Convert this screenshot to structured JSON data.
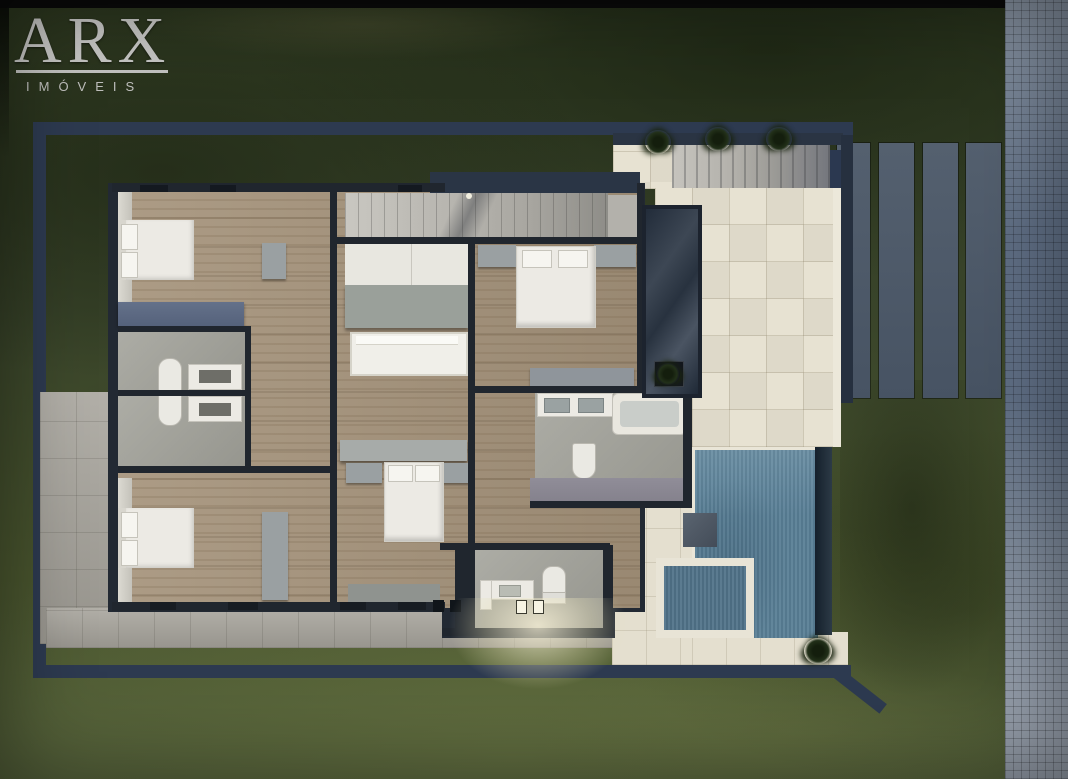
{
  "watermark": {
    "brand": "ARX",
    "subtitle": "IMÓVEIS"
  },
  "scene": {
    "description": "top-down 3D architectural floor plan render of a house at dusk",
    "view": "aerial"
  },
  "palette": {
    "grass_dark": "#2f3a21",
    "grass_light": "#53603a",
    "lot_wall_navy": "#2d3a50",
    "house_wall": "#20262e",
    "wood_floor": "#a5937b",
    "bathroom_floor": "#a3a39b",
    "patio_tile": "#e7e2d2",
    "pool_water": "#587e95",
    "spa_water": "#517389",
    "road_cobble": "#5f6e84",
    "driveway_slat": "#4e5a6a",
    "walkway_gray": "#a9a69e",
    "furniture_white": "#eceae4",
    "cabinet_gray": "#9aa0a2",
    "wardrobe_blue": "#5d6b84",
    "logo_silver": "#c7c7c5"
  }
}
